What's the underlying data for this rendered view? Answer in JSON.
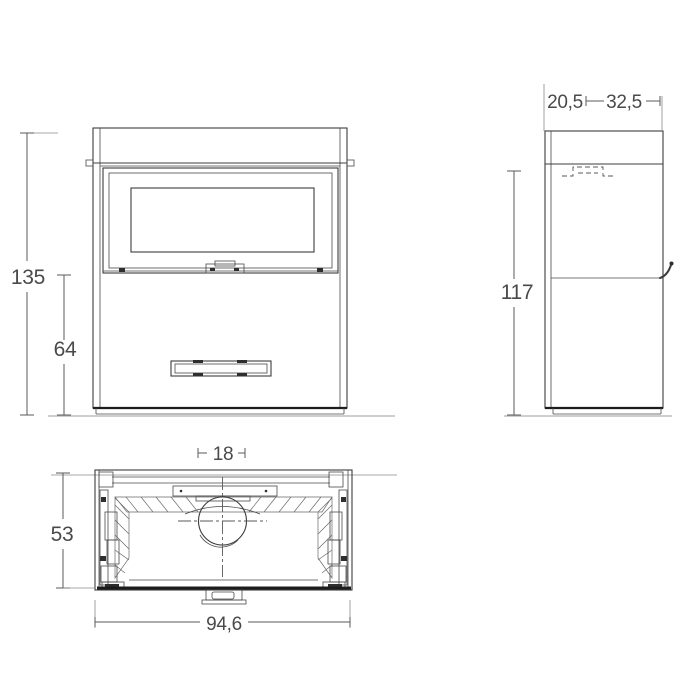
{
  "drawing": {
    "views": {
      "front": {
        "label_total_height": "135",
        "label_lower_height": "64"
      },
      "side": {
        "label_depth_front": "20,5",
        "label_depth_rear": "32,5",
        "label_height": "117"
      },
      "plan": {
        "label_flue_diameter": "18",
        "label_depth": "53",
        "label_width": "94,6"
      }
    },
    "colors": {
      "line": "#3c3c3c",
      "dimension": "#5a5a5a",
      "label": "#4a4a4a",
      "ground": "#b0b0b0",
      "emphasis": "#1c1c1c",
      "background": "#ffffff"
    }
  }
}
